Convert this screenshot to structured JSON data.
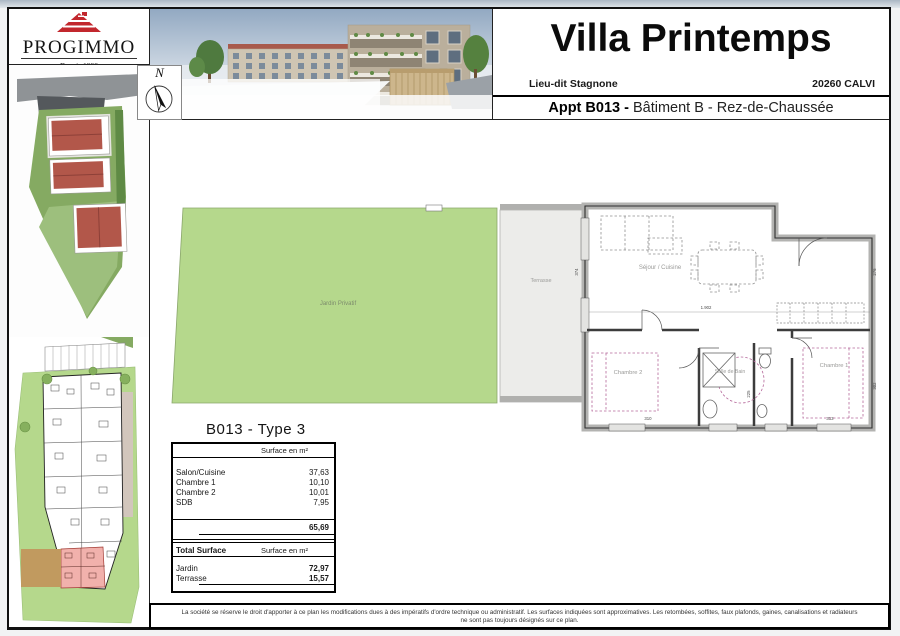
{
  "brand": {
    "name": "PROGIMMO",
    "tagline": "Depuis 1998",
    "logo_color": "#c2272d"
  },
  "header": {
    "title": "Villa Printemps",
    "address_left": "Lieu-dit Stagnone",
    "address_right": "20260 CALVI",
    "appt_bold": "Appt B013 -",
    "appt_rest": "Bâtiment B - Rez-de-Chaussée"
  },
  "compass": {
    "label": "N"
  },
  "plan": {
    "rooms": {
      "sejour": "Séjour / Cuisine",
      "chambre1": "Chambre 1",
      "chambre2": "Chambre 2",
      "sdb": "Salle de Bain",
      "jardin": "Jardin Privatif",
      "terrasse": "Terrasse"
    },
    "dims": {
      "side_left": "374",
      "width_main": "1.902",
      "side_right": "276",
      "ch2_width": "310",
      "ch1_width": "313",
      "ch1_height": "302",
      "sdb_height": "225"
    }
  },
  "table": {
    "title": "B013 - Type 3",
    "col_header": "Surface en m²",
    "rows": [
      {
        "label": "Salon/Cuisine",
        "value": "37,63"
      },
      {
        "label": "Chambre 1",
        "value": "10,10"
      },
      {
        "label": "Chambre 2",
        "value": "10,01"
      },
      {
        "label": "SDB",
        "value": "7,95"
      }
    ],
    "total": "65,69",
    "total_header_left": "Total Surface",
    "ext_rows": [
      {
        "label": "Jardin",
        "value": "72,97"
      },
      {
        "label": "Terrasse",
        "value": "15,57"
      }
    ]
  },
  "footer": {
    "line1": "La société se réserve le droit d'apporter à ce plan les modifications dues à des impératifs d'ordre technique ou administratif. Les surfaces indiquées sont approximatives. Les retombées, soffites, faux plafonds, gaines, canalisations et radiateurs",
    "line2": "ne sont pas toujours désignés sur ce plan."
  },
  "colors": {
    "garden_green": "#b5d88c",
    "terrace_grey": "#ececea",
    "unit_highlight_pink": "#f1b1ac",
    "ground_tan": "#c19a5f",
    "logo_red": "#c2272d"
  }
}
